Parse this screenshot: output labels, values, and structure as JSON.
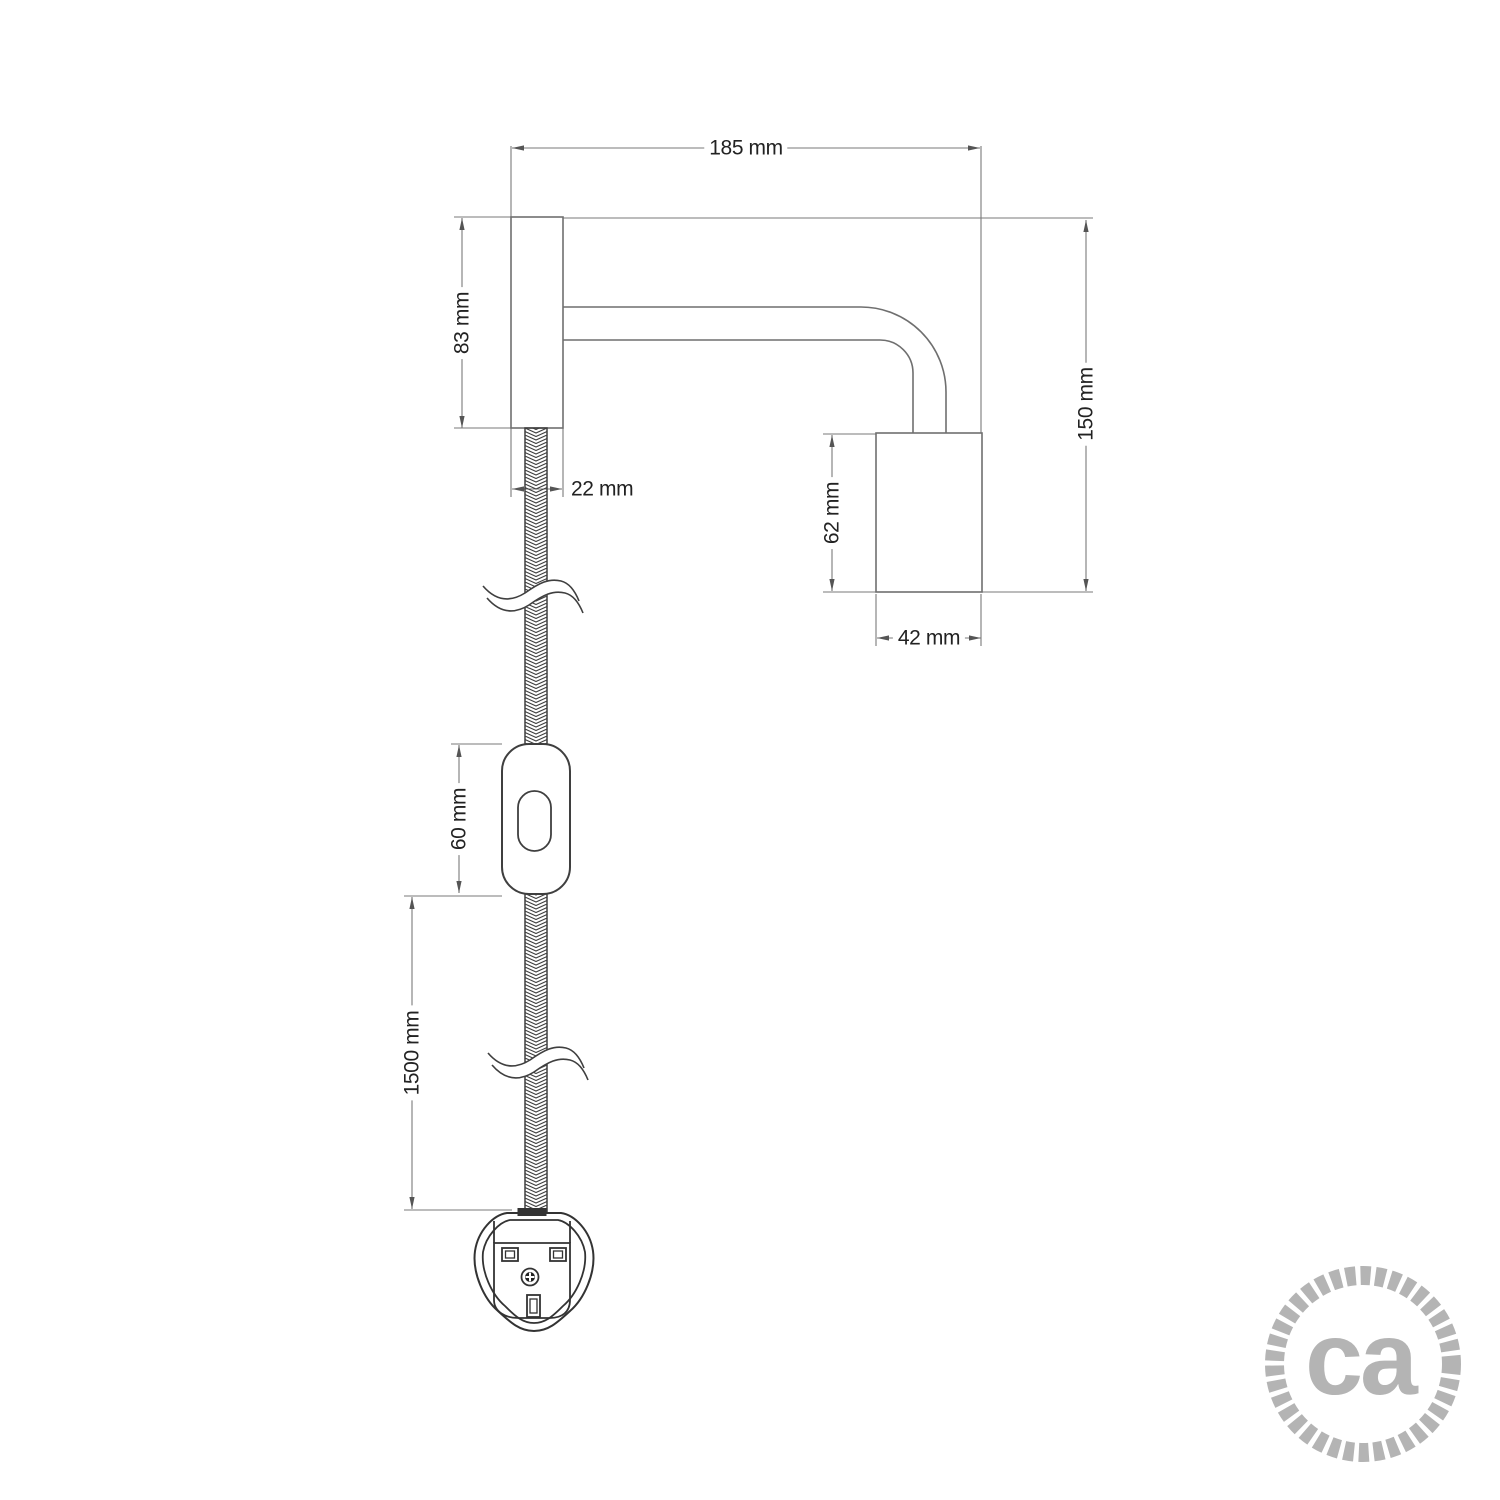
{
  "page": {
    "background": "#ffffff",
    "type": "product technical dimension drawing"
  },
  "drawing": {
    "subject": "wall lamp with bent tube arm, braided power cable, inline switch and UK plug",
    "units": "mm",
    "fixture_line_color": "#6f6f6f",
    "dimension_line_color": "#7a7a7a",
    "component_line_color": "#3f3f3f"
  },
  "dimensions": {
    "total_width": "185 mm",
    "mount_height": "83 mm",
    "mount_width": "22 mm",
    "total_height": "150 mm",
    "socket_height": "62 mm",
    "socket_width": "42 mm",
    "switch_length": "60 mm",
    "cable_length": "1500 mm"
  },
  "logo": {
    "text": "ca",
    "color": "#b4b4b4"
  }
}
